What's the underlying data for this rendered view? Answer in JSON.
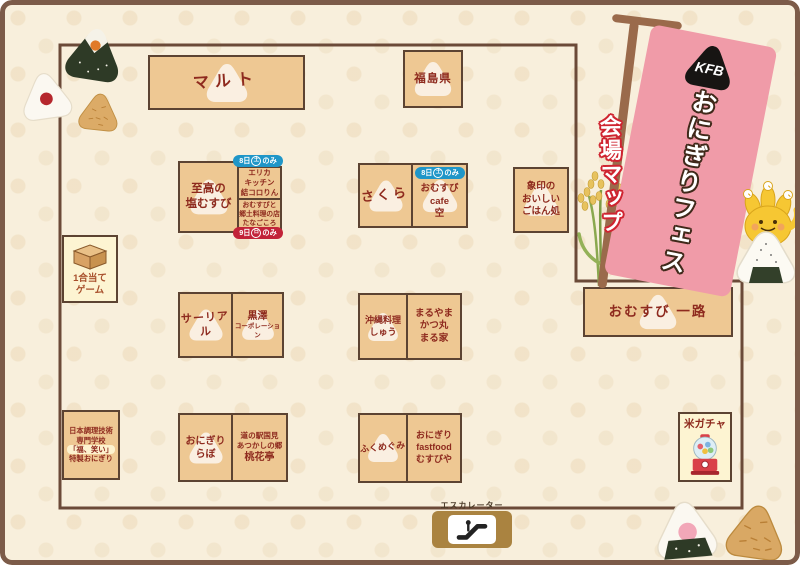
{
  "banner": {
    "logo": "KFB",
    "title": "おにぎりフェス",
    "subtitle": "会場マップ"
  },
  "badges": {
    "day8": {
      "pre": "8日",
      "day": "土",
      "post": "のみ"
    },
    "day9": {
      "pre": "9日",
      "day": "日",
      "post": "のみ"
    }
  },
  "escalator": {
    "label": "エスカレーター"
  },
  "booths": {
    "maruto": {
      "lines": [
        "マルト"
      ]
    },
    "fukushima": {
      "lines": [
        "福島県"
      ]
    },
    "shiko": {
      "lines": [
        "至高の",
        "塩むすび"
      ]
    },
    "erika": {
      "lines": [
        "エリカ",
        "キッチン",
        "結コロりん"
      ]
    },
    "tanagokoro": {
      "lines": [
        "おむすびと",
        "郷土料理の店",
        "たなごころ"
      ]
    },
    "sakura": {
      "lines": [
        "さくら"
      ]
    },
    "cafe_sora": {
      "lines": [
        "おむすび",
        "cafe",
        "空"
      ]
    },
    "zojirushi": {
      "lines": [
        "象印の",
        "おいしい",
        "ごはん処"
      ]
    },
    "ichigo_game": {
      "lines": [
        "1合当て",
        "ゲーム"
      ]
    },
    "surreal": {
      "lines": [
        "サーリアル"
      ]
    },
    "kurosawa": {
      "lines": [
        "黒澤",
        "コーポレーション"
      ]
    },
    "okinawa": {
      "lines": [
        "沖縄料理",
        "しゅう"
      ]
    },
    "maruyama": {
      "lines": [
        "まるやま",
        "かつ丸",
        "まる家"
      ]
    },
    "ichiro": {
      "lines": [
        "おむすび 一路"
      ]
    },
    "nihon_chori": {
      "lines": [
        "日本調理技術",
        "専門学校",
        "「福、笑い」",
        "特製おにぎり"
      ]
    },
    "onigiri_lab": {
      "lines": [
        "おにぎり",
        "らぼ"
      ]
    },
    "tokaei": {
      "lines": [
        "道の駅国見",
        "あつかしの郷",
        "桃花亭"
      ]
    },
    "fukumegumi": {
      "lines": [
        "ふくめぐみ"
      ]
    },
    "musubiya": {
      "lines": [
        "おにぎり",
        "fastfood",
        "むすびや"
      ]
    },
    "kome_gacha": {
      "lines": [
        "米ガチャ"
      ]
    }
  },
  "colors": {
    "booth_fill": "#eec893",
    "booth_border": "#5c4332",
    "booth_text": "#8e2a1e",
    "cream_fill": "#fdf4d2",
    "badge_blue": "#1f96c8",
    "badge_red": "#c22339",
    "flag_pink": "#f09ba8",
    "map_border": "#6b4a38",
    "page_frame": "#7c5b49",
    "escalator_gold": "#aa8340"
  }
}
